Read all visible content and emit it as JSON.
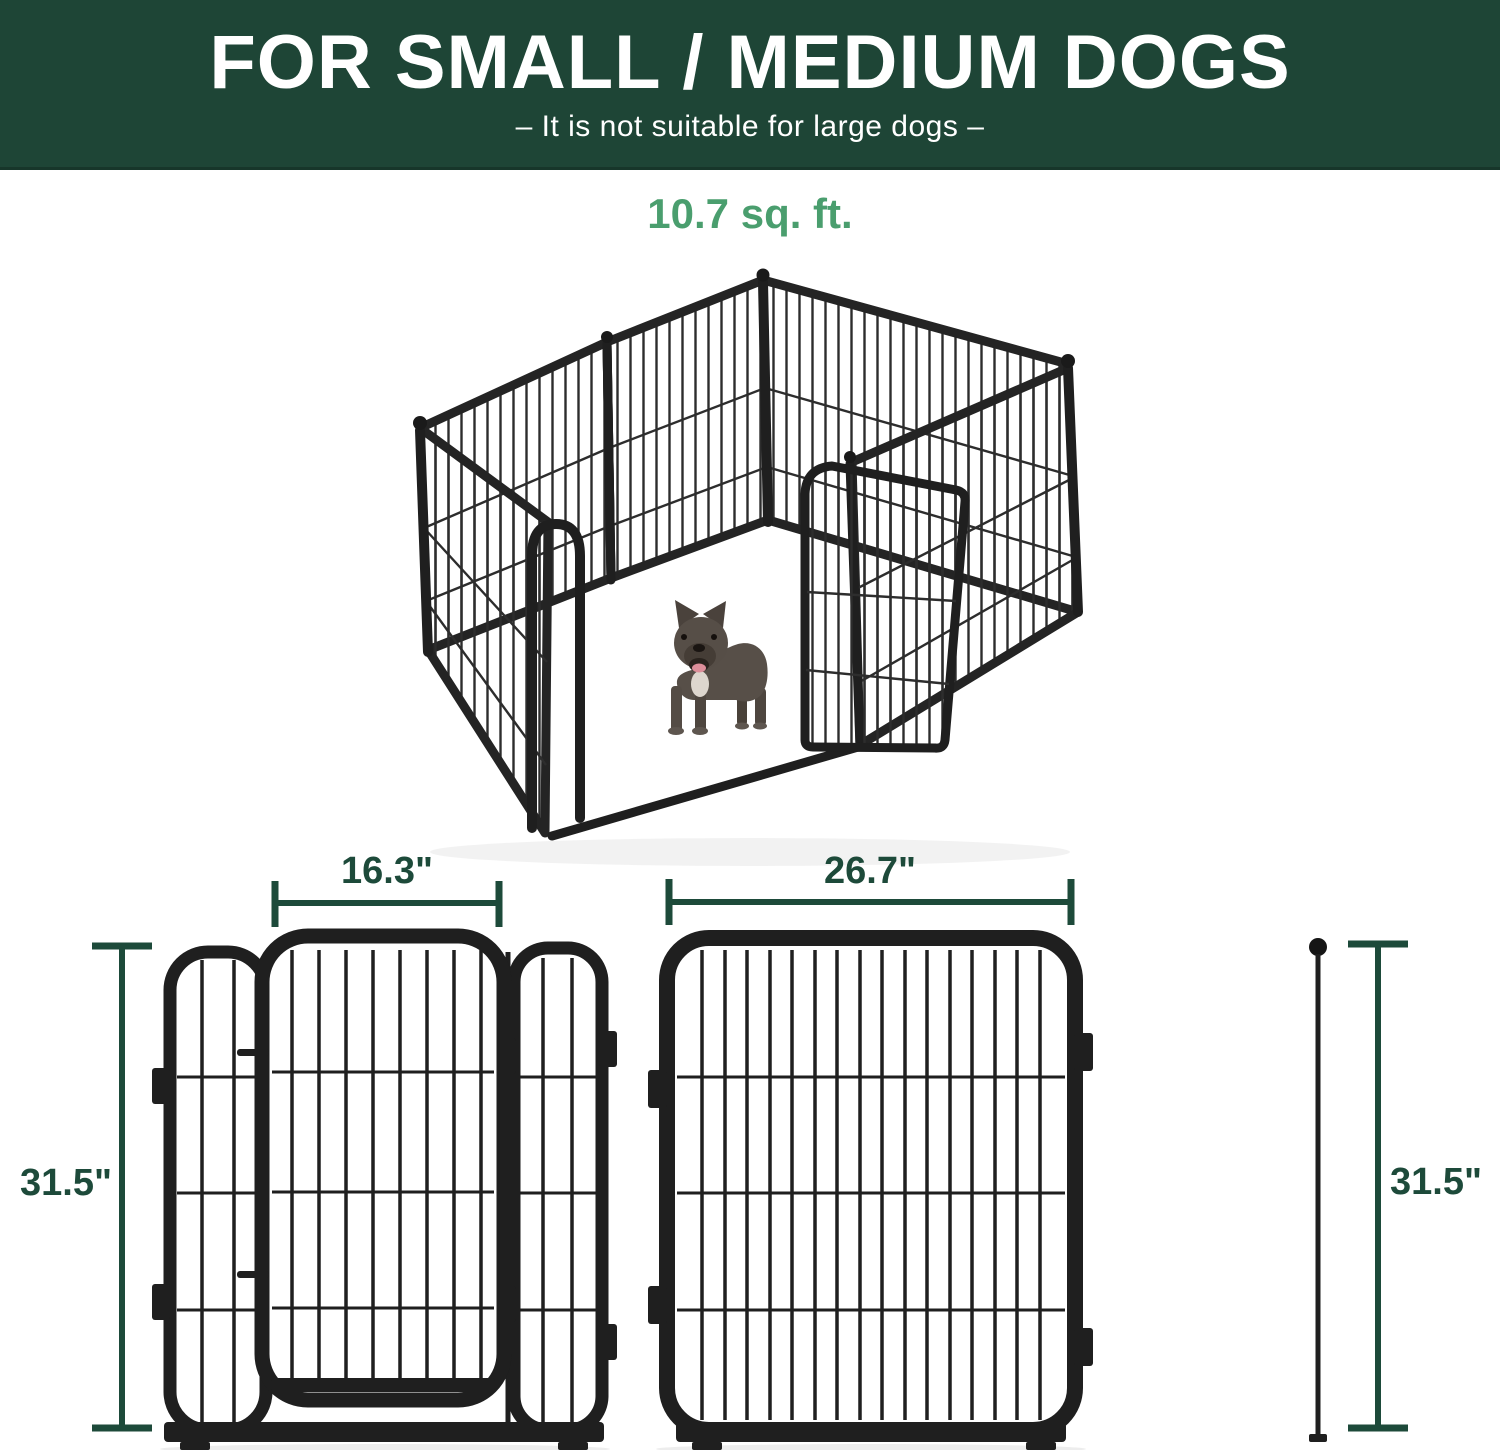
{
  "header": {
    "title": "FOR SMALL / MEDIUM DOGS",
    "subtitle": "–  It is not suitable for large dogs  –"
  },
  "capacity": {
    "area": "10.7 sq. ft."
  },
  "dimensions": {
    "door_section_width": "16.3\"",
    "large_panel_width": "26.7\"",
    "left_height": "31.5\"",
    "right_height": "31.5\""
  },
  "illustration": {
    "top": "3d-playpen-with-french-bulldog",
    "bottom_left": "door-section-front-view",
    "bottom_right": "large-panel-front-view"
  },
  "colors": {
    "banner_green": "#1e4536",
    "accent_green": "#4a9e6e",
    "dimension_green": "#1d4a3a",
    "frame_black": "#1f1f1f"
  }
}
